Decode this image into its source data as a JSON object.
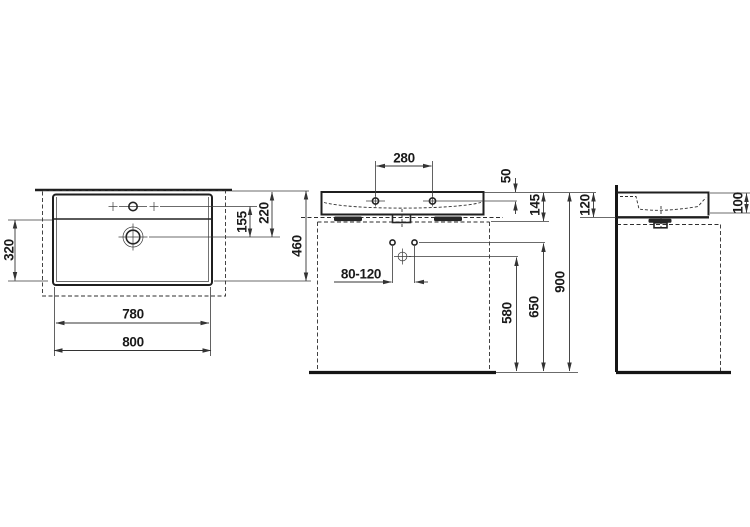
{
  "drawing": {
    "type": "washbasin-dimension-drawing",
    "units": "mm",
    "colors": {
      "line": "#1f1f1f",
      "background": "#ffffff",
      "text": "#1a1a1a"
    },
    "views": {
      "plan": {
        "dims": {
          "bowl_depth": "320",
          "tap_to_drain": "155",
          "rim_to_drain": "220",
          "total_depth": "460",
          "inner_width": "780",
          "total_width": "800"
        }
      },
      "front": {
        "dims": {
          "tap_hole_spacing": "280",
          "rim_to_tap_axis": "50",
          "rim_to_underside": "145",
          "fixing_spacing_range": "80-120",
          "floor_to_trap": "580",
          "floor_to_fixing": "650",
          "floor_to_rim": "900"
        }
      },
      "side": {
        "dims": {
          "rear_height": "120",
          "front_height": "100"
        }
      }
    }
  }
}
